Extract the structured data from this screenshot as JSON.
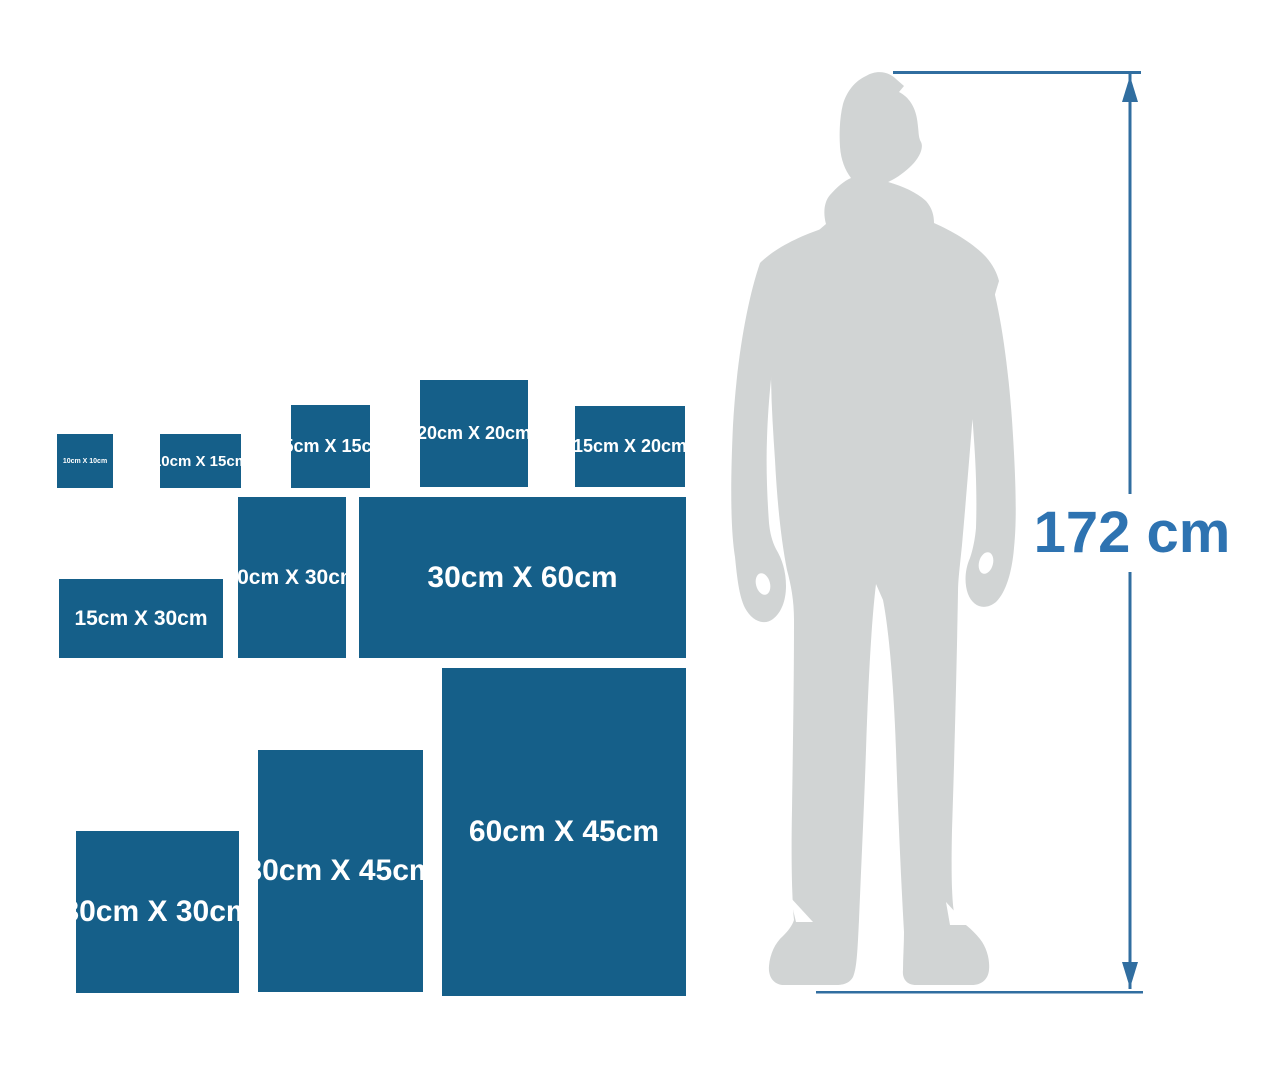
{
  "colors": {
    "background": "#ffffff",
    "box_fill": "#155f89",
    "box_text": "#ffffff",
    "silhouette": "#d1d4d4",
    "measure_line": "#316ea0",
    "measure_text": "#2e73b1"
  },
  "size_boxes": [
    {
      "label": "10cm X 10cm",
      "width_cm": 10,
      "height_cm": 10
    },
    {
      "label": "10cm X 15cm",
      "width_cm": 15,
      "height_cm": 10
    },
    {
      "label": "15cm X 15cm",
      "width_cm": 15,
      "height_cm": 15
    },
    {
      "label": "20cm X 20cm",
      "width_cm": 20,
      "height_cm": 20
    },
    {
      "label": "15cm X 20cm",
      "width_cm": 20,
      "height_cm": 15
    },
    {
      "label": "15cm X 30cm",
      "width_cm": 30,
      "height_cm": 15
    },
    {
      "label": "20cm X 30cm",
      "width_cm": 20,
      "height_cm": 30
    },
    {
      "label": "30cm X 60cm",
      "width_cm": 60,
      "height_cm": 30
    },
    {
      "label": "30cm X 30cm",
      "width_cm": 30,
      "height_cm": 30
    },
    {
      "label": "30cm X 45cm",
      "width_cm": 30,
      "height_cm": 45
    },
    {
      "label": "60cm X 45cm",
      "width_cm": 45,
      "height_cm": 60
    }
  ],
  "person": {
    "height_label": "172 cm"
  }
}
